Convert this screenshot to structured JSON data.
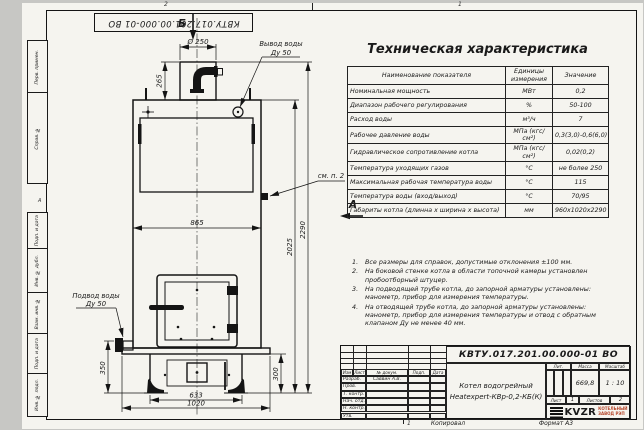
{
  "colors": {
    "paper": "#f5f4ef",
    "ink": "#1a1a1a",
    "logo_red": "#b5452a",
    "background": "#c7c7c4"
  },
  "frame": {
    "doc_number_stamp": "КВТУ.017.201.00.000-01 ВО",
    "zone_top_left": "2",
    "zone_top_right": "1",
    "zone_bottom": "1",
    "zone_left": "А",
    "left_margin_labels": [
      "Перв. примен.",
      "Справ. №",
      "Подп. и дата",
      "Инв. № дубл.",
      "Взам. инв. №",
      "Подп. и дата",
      "Инв. № подл."
    ]
  },
  "drawing": {
    "view_b": "Б",
    "view_a": "А",
    "outlet_label_1": "Вывод воды",
    "outlet_label_2": "Ду 50",
    "inlet_label_1": "Подвод воды",
    "inlet_label_2": "Ду 50",
    "see_note_label": "см. п. 2",
    "dims": {
      "dia": "Ø 250",
      "d265": "265",
      "d865": "865",
      "d2025": "2025",
      "d2290": "2290",
      "d350": "350",
      "d300": "300",
      "d633": "633",
      "d1020": "1020"
    }
  },
  "spec_table": {
    "title": "Техническая характеристика",
    "headers": [
      "Наименование показателя",
      "Единицы измерения",
      "Значение"
    ],
    "rows": [
      [
        "Номинальная мощность",
        "МВт",
        "0,2"
      ],
      [
        "Диапазон рабочего регулирования",
        "%",
        "50-100"
      ],
      [
        "Расход воды",
        "м³/ч",
        "7"
      ],
      [
        "Рабочее давление воды",
        "МПа (кгс/см²)",
        "0,3(3,0)-0,6(6,0)"
      ],
      [
        "Гидравлическое сопротивление котла",
        "МПа (кгс/см²)",
        "0,02(0,2)"
      ],
      [
        "Температура уходящих газов",
        "°С",
        "не более 250"
      ],
      [
        "Максимальная рабочая температура воды",
        "°С",
        "115"
      ],
      [
        "Температура воды (вход/выход)",
        "°С",
        "70/95"
      ],
      [
        "Габариты котла (длинна х ширина х высота)",
        "мм",
        "960х1020х2290"
      ]
    ]
  },
  "notes": [
    {
      "num": "1.",
      "text": "Все размеры для справок, допустимые отклонения ±100 мм."
    },
    {
      "num": "2.",
      "text": "На боковой стенке котла в области топочной камеры установлен пробоотборный штуцер."
    },
    {
      "num": "3.",
      "text": "На подводящей трубе котла, до запорной арматуры установлены: манометр, прибор для измерения температуры."
    },
    {
      "num": "4.",
      "text": "На отводящей трубе котла, до запорной арматуры установлены: манометр, прибор для измерения температуры и отвод с обратным клапаном Ду не менее 40 мм."
    }
  ],
  "title_block": {
    "doc_number": "КВТУ.017.201.00.000-01 ВО",
    "name_line1": "Котел водогрейный",
    "name_line2": "Heatexpert-КВр-0,2-КБ(К)",
    "cols": {
      "izm": "Изм",
      "list": "Лист",
      "doc": "№ докум.",
      "podp": "Подп.",
      "data": "Дата"
    },
    "rows": [
      {
        "label": "Разраб.",
        "value": "Саввин А.В."
      },
      {
        "label": "Пров.",
        "value": ""
      },
      {
        "label": "Т. контр.",
        "value": ""
      },
      {
        "label": "Нач. отд.",
        "value": ""
      },
      {
        "label": "Н. контр.",
        "value": ""
      },
      {
        "label": "Утв.",
        "value": ""
      }
    ],
    "lit_label": "Лит.",
    "mass_label": "Масса",
    "scale_label": "Масштаб",
    "mass_value": "669,8",
    "scale_value": "1 : 10",
    "sheet_label": "Лист",
    "sheet_value": "1",
    "sheets_label": "Листов",
    "sheets_value": "2",
    "brand": "KVZR",
    "brand_line1": "КОТЕЛЬНЫЙ",
    "brand_line2": "ЗАВОД  РЭП"
  },
  "footer": {
    "copied_label": "Копировал",
    "format_label": "Формат А3"
  }
}
